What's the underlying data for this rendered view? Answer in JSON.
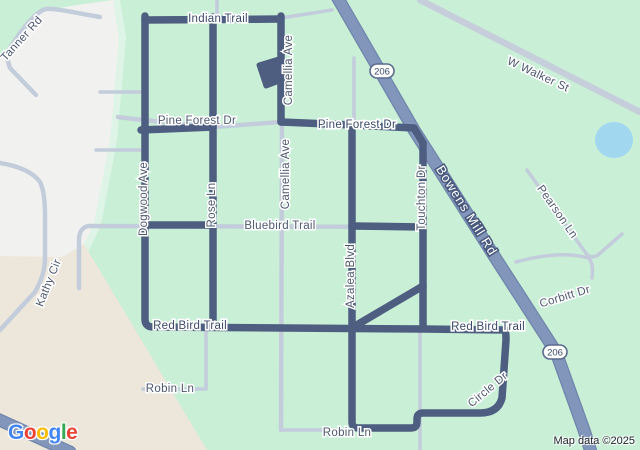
{
  "attribution": "Map data ©2025",
  "google_logo": {
    "letters": [
      {
        "ch": "G",
        "color": "#4285F4"
      },
      {
        "ch": "o",
        "color": "#EA4335"
      },
      {
        "ch": "o",
        "color": "#FBBC05"
      },
      {
        "ch": "g",
        "color": "#4285F4"
      },
      {
        "ch": "l",
        "color": "#34A853"
      },
      {
        "ch": "e",
        "color": "#EA4335"
      }
    ]
  },
  "map": {
    "colors": {
      "green": "#c9efd7",
      "band": "#def4e6",
      "grayArea": "#f1f2f0",
      "beige": "#ece7da",
      "pond": "#a2d7f0",
      "road": "#c3ccdb",
      "roadWide": "#c7cedb",
      "hwy": "#8196ba",
      "hwyCase": "#7085ab",
      "route": "#4e5e81",
      "lblStreet": "#4d586f",
      "lblRoute": "#3b4a68",
      "hwyLblHalo": "#47587c",
      "shieldBorder": "#5b6b8e",
      "shieldText": "#3d4e70",
      "attrText": "#20242c"
    },
    "labels": [
      {
        "text": "Tanner Rd",
        "x": 22,
        "y": 39,
        "rot": -48,
        "kind": "street"
      },
      {
        "text": "Indian Trail",
        "x": 218,
        "y": 19,
        "rot": 0,
        "kind": "onroute"
      },
      {
        "text": "Camellia Ave",
        "x": 289,
        "y": 70,
        "rot": -90,
        "kind": "street"
      },
      {
        "text": "Pine Forest Dr",
        "x": 197,
        "y": 121,
        "rot": 0,
        "kind": "street"
      },
      {
        "text": "Pine Forest Dr",
        "x": 357,
        "y": 125,
        "rot": 0,
        "kind": "onroute"
      },
      {
        "text": "W Walker St",
        "x": 538,
        "y": 75,
        "rot": 25,
        "kind": "street"
      },
      {
        "text": "Dogwood Ave",
        "x": 144,
        "y": 199,
        "rot": -90,
        "kind": "street"
      },
      {
        "text": "Rose Ln",
        "x": 212,
        "y": 205,
        "rot": -90,
        "kind": "street"
      },
      {
        "text": "Camellia Ave",
        "x": 286,
        "y": 174,
        "rot": -90,
        "kind": "street"
      },
      {
        "text": "Bluebird Trail",
        "x": 280,
        "y": 226,
        "rot": 0,
        "kind": "street"
      },
      {
        "text": "Azalea Blvd",
        "x": 351,
        "y": 276,
        "rot": -90,
        "kind": "street"
      },
      {
        "text": "Touchton Dr",
        "x": 422,
        "y": 198,
        "rot": -90,
        "kind": "street"
      },
      {
        "text": "Bowens Mill Rd",
        "x": 466,
        "y": 211,
        "rot": 58,
        "kind": "highway"
      },
      {
        "text": "Pearson Ln",
        "x": 557,
        "y": 212,
        "rot": 55,
        "kind": "street"
      },
      {
        "text": "Corbitt Dr",
        "x": 565,
        "y": 297,
        "rot": -17,
        "kind": "street"
      },
      {
        "text": "Kathy Cir",
        "x": 49,
        "y": 283,
        "rot": -68,
        "kind": "street"
      },
      {
        "text": "Red Bird Trail",
        "x": 190,
        "y": 326,
        "rot": 0,
        "kind": "onroute"
      },
      {
        "text": "Red Bird Trail",
        "x": 488,
        "y": 327,
        "rot": 0,
        "kind": "onroute"
      },
      {
        "text": "Robin Ln",
        "x": 170,
        "y": 389,
        "rot": 0,
        "kind": "street"
      },
      {
        "text": "Circle Dr",
        "x": 488,
        "y": 390,
        "rot": -40,
        "kind": "street"
      },
      {
        "text": "Robin Ln",
        "x": 347,
        "y": 433,
        "rot": 0,
        "kind": "street"
      }
    ],
    "shields": [
      {
        "label": "206",
        "x": 382,
        "y": 71
      },
      {
        "label": "206",
        "x": 555,
        "y": 352
      }
    ]
  }
}
